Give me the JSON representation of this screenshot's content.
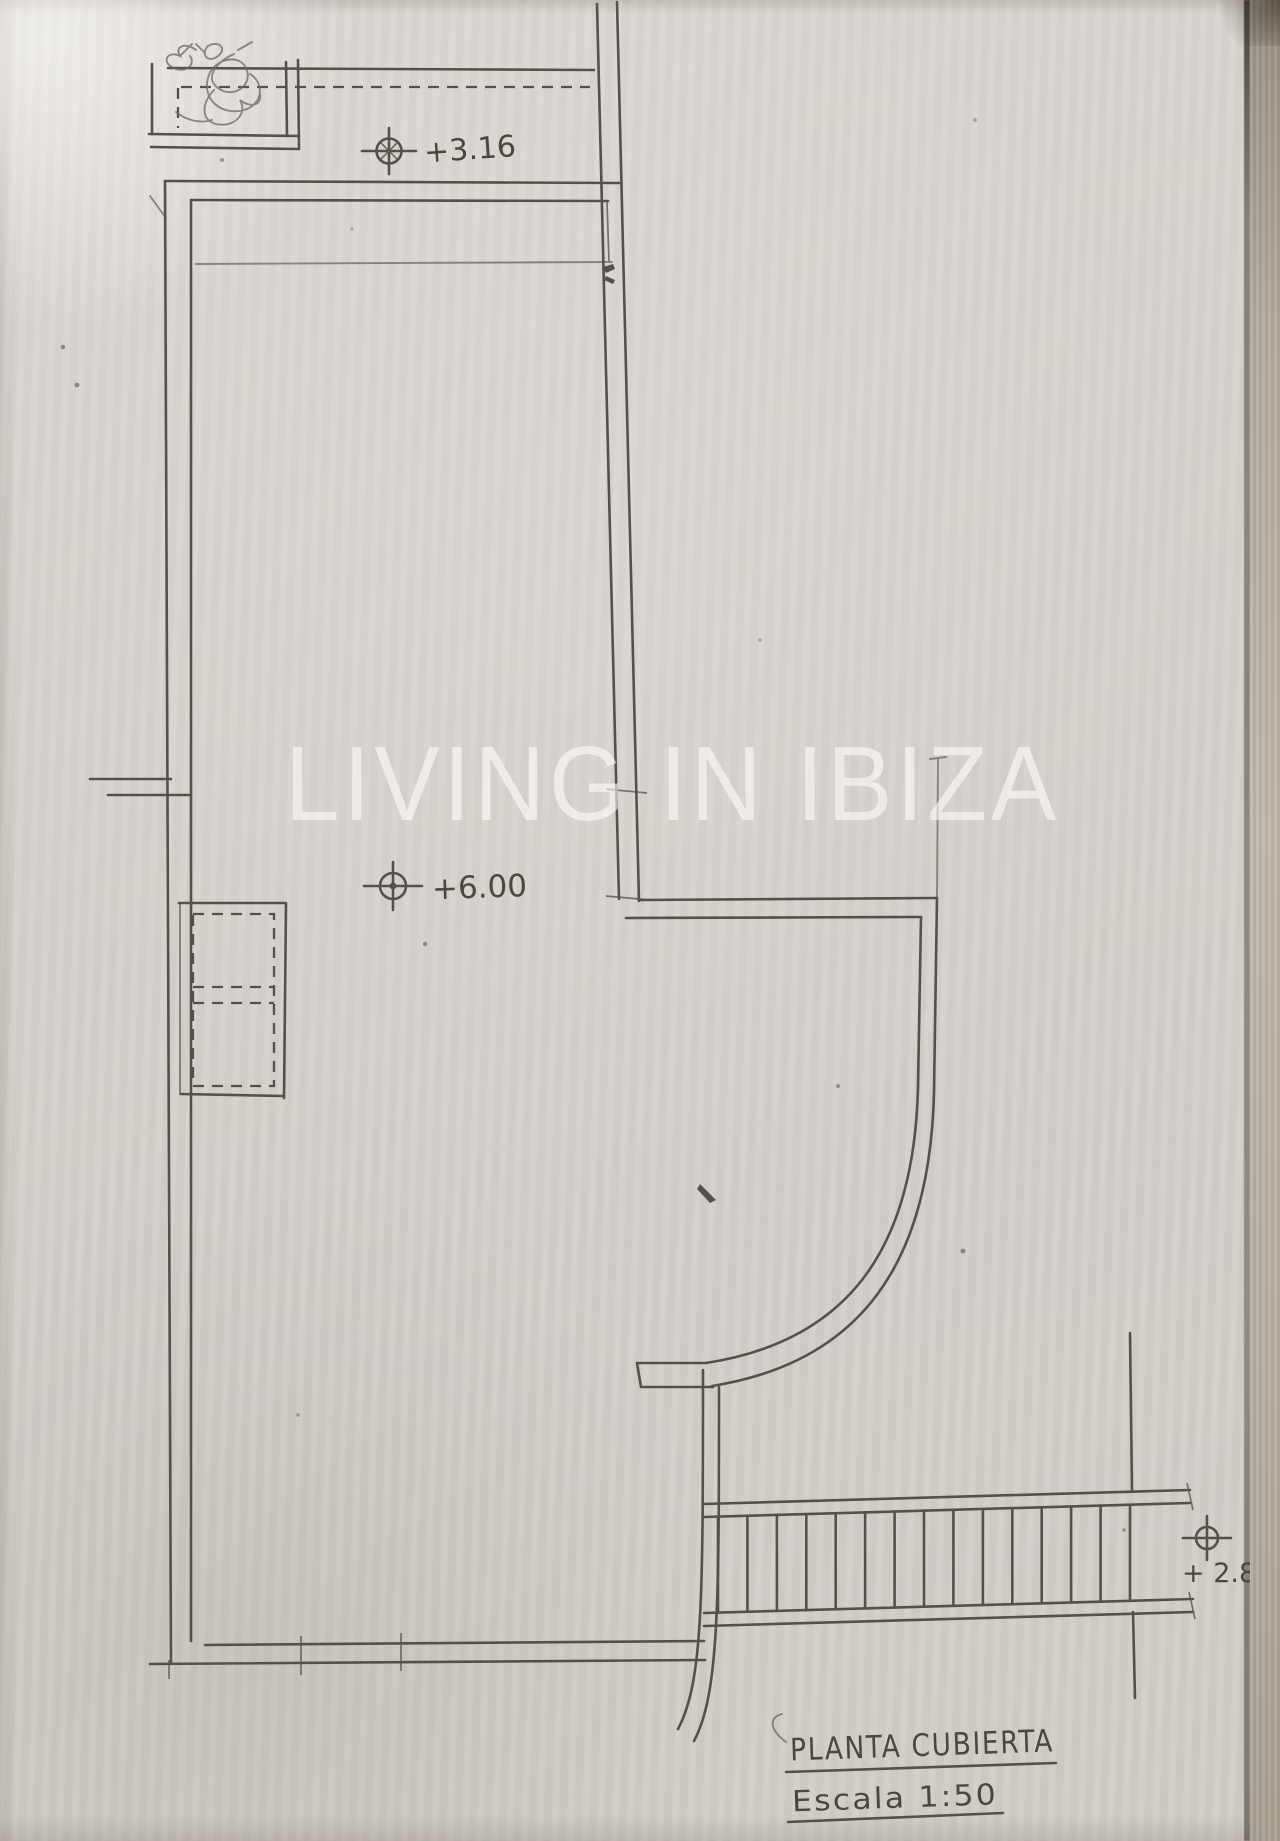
{
  "watermark": {
    "text": "LIVING IN IBIZA",
    "color": "#ffffff"
  },
  "annotations": {
    "level_roof": {
      "label": "+3.16",
      "symbol": "crosshair-level-marker"
    },
    "level_main": {
      "label": "+6.00",
      "symbol": "crosshair-level-marker"
    },
    "level_stairs": {
      "label": "+ 2.80",
      "symbol": "crosshair-level-marker"
    }
  },
  "titles": {
    "plan_title": "PLANTA CUBIERTA",
    "scale_label": "Escala 1:50"
  },
  "stairs": {
    "step_count": 15
  },
  "colors": {
    "paper": "#d6d2cd",
    "pencil": "#57504a",
    "watermark": "#ffffff"
  }
}
